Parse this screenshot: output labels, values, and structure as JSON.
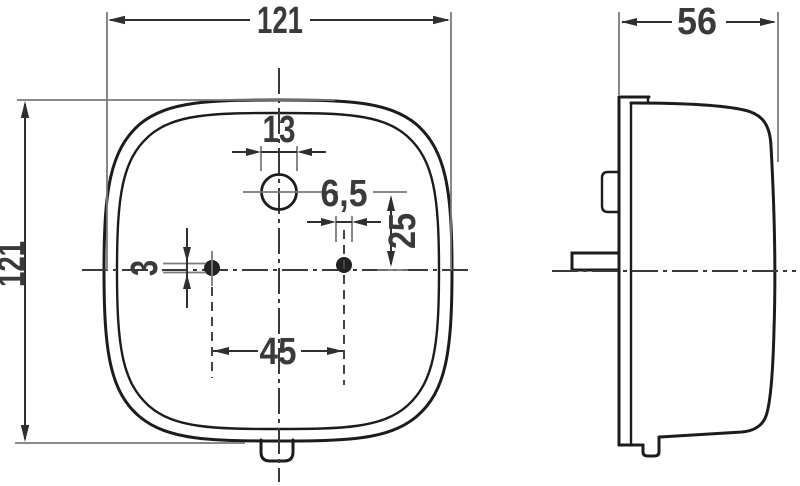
{
  "drawing": {
    "type": "technical-dimension-drawing",
    "views": {
      "front_view_name": "front-view",
      "side_view_name": "side-view"
    },
    "front_view": {
      "overall_width": "121",
      "overall_height": "121",
      "center_hole_diameter": "13",
      "right_hole_diameter": "6,5",
      "hole_offset_from_center": "25",
      "left_hole_diameter": "3",
      "hole_spacing": "45"
    },
    "side_view": {
      "overall_depth": "56"
    },
    "colors": {
      "background": "#ffffff",
      "outline": "#1c1c1c",
      "dimension_lines": "#2f2f2f",
      "extension_lines": "#7a7a7a",
      "text": "#3a3a3a"
    }
  }
}
